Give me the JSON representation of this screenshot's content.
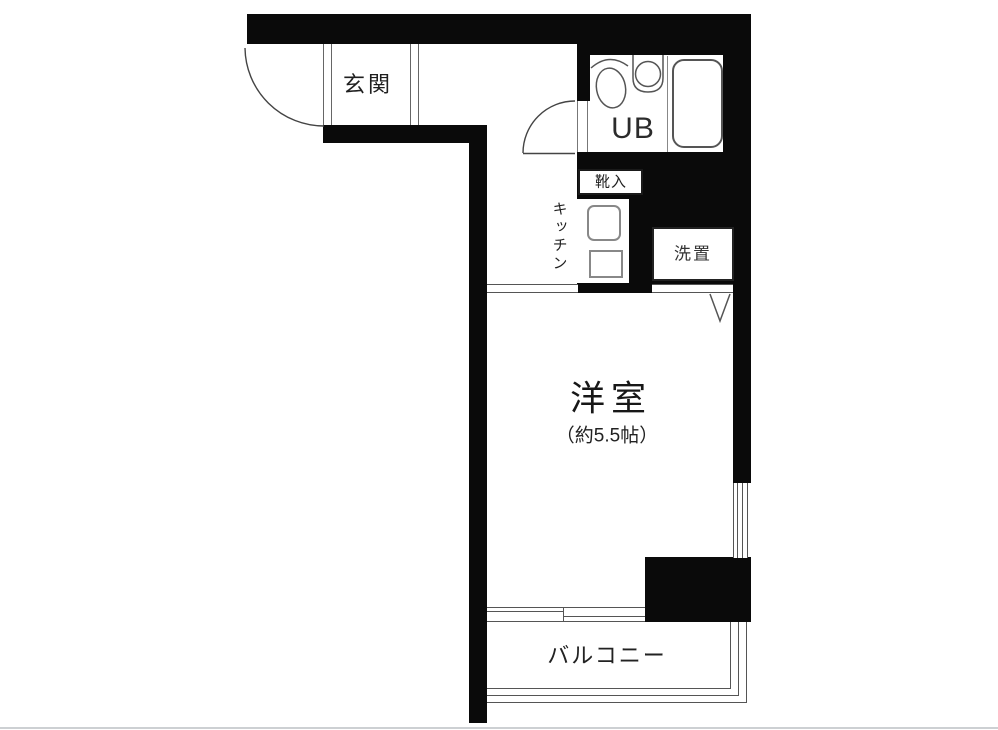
{
  "floorplan": {
    "title": "1R apartment floor plan",
    "rooms": {
      "entrance_label": "玄関",
      "bath_label": "UB",
      "shoe_cabinet_label": "靴入",
      "kitchen_label": "キッチン",
      "laundry_label": "洗置",
      "main_room_label": "洋室",
      "main_room_size": "（約5.5帖）",
      "balcony_label": "バルコニー"
    },
    "colors": {
      "wall": "#0a0a0a",
      "thin_line": "#555555",
      "text": "#1f1f1f",
      "background": "#ffffff",
      "page_frame_line": "#cdd0d3"
    }
  }
}
